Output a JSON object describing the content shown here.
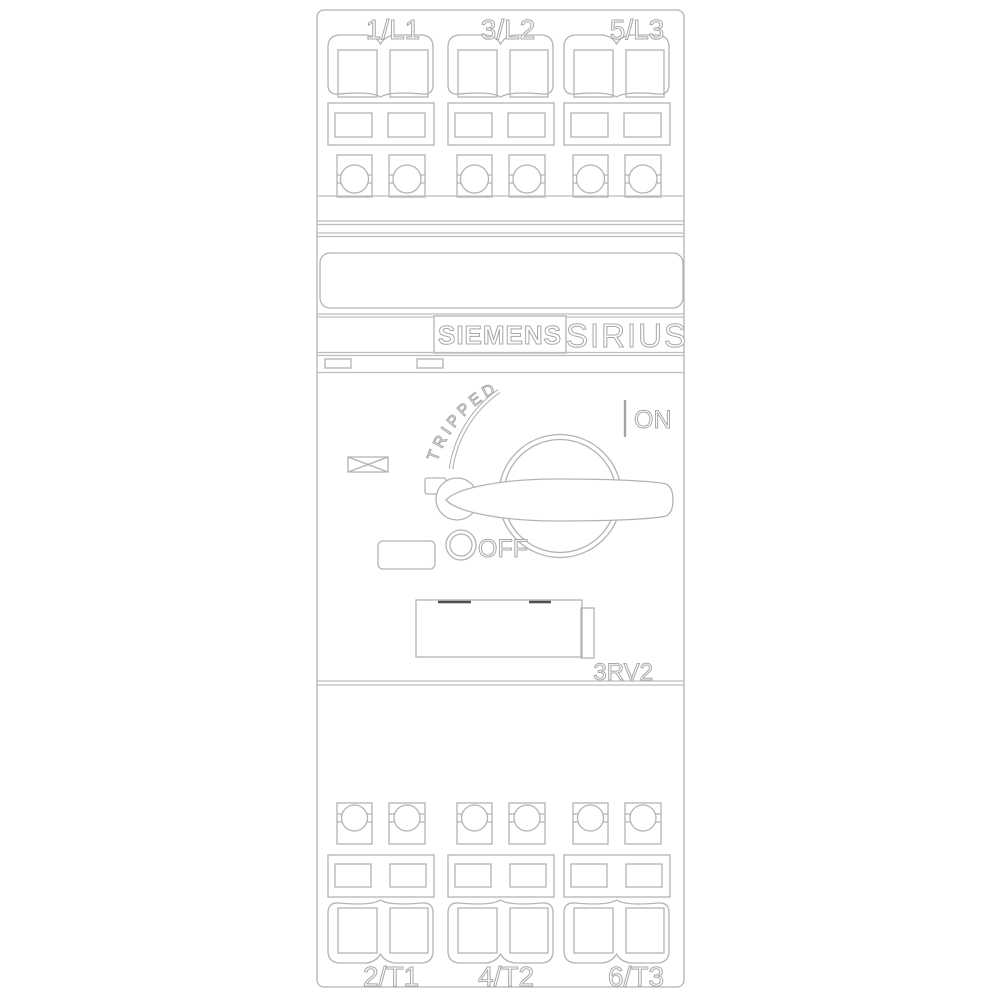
{
  "device": {
    "brand": "SIEMENS",
    "series": "SIRIUS",
    "model": "3RV2",
    "state_labels": {
      "tripped": "TRIPPED",
      "on": "ON",
      "off": "OFF"
    },
    "top_terminals": [
      "1/L1",
      "3/L2",
      "5/L3"
    ],
    "bottom_terminals": [
      "2/T1",
      "4/T2",
      "6/T3"
    ],
    "colors": {
      "line": "#b3b3b3",
      "text_outline": "#a8a8a8",
      "setting_mark": "#4f4f4f",
      "background": "#ffffff"
    }
  }
}
